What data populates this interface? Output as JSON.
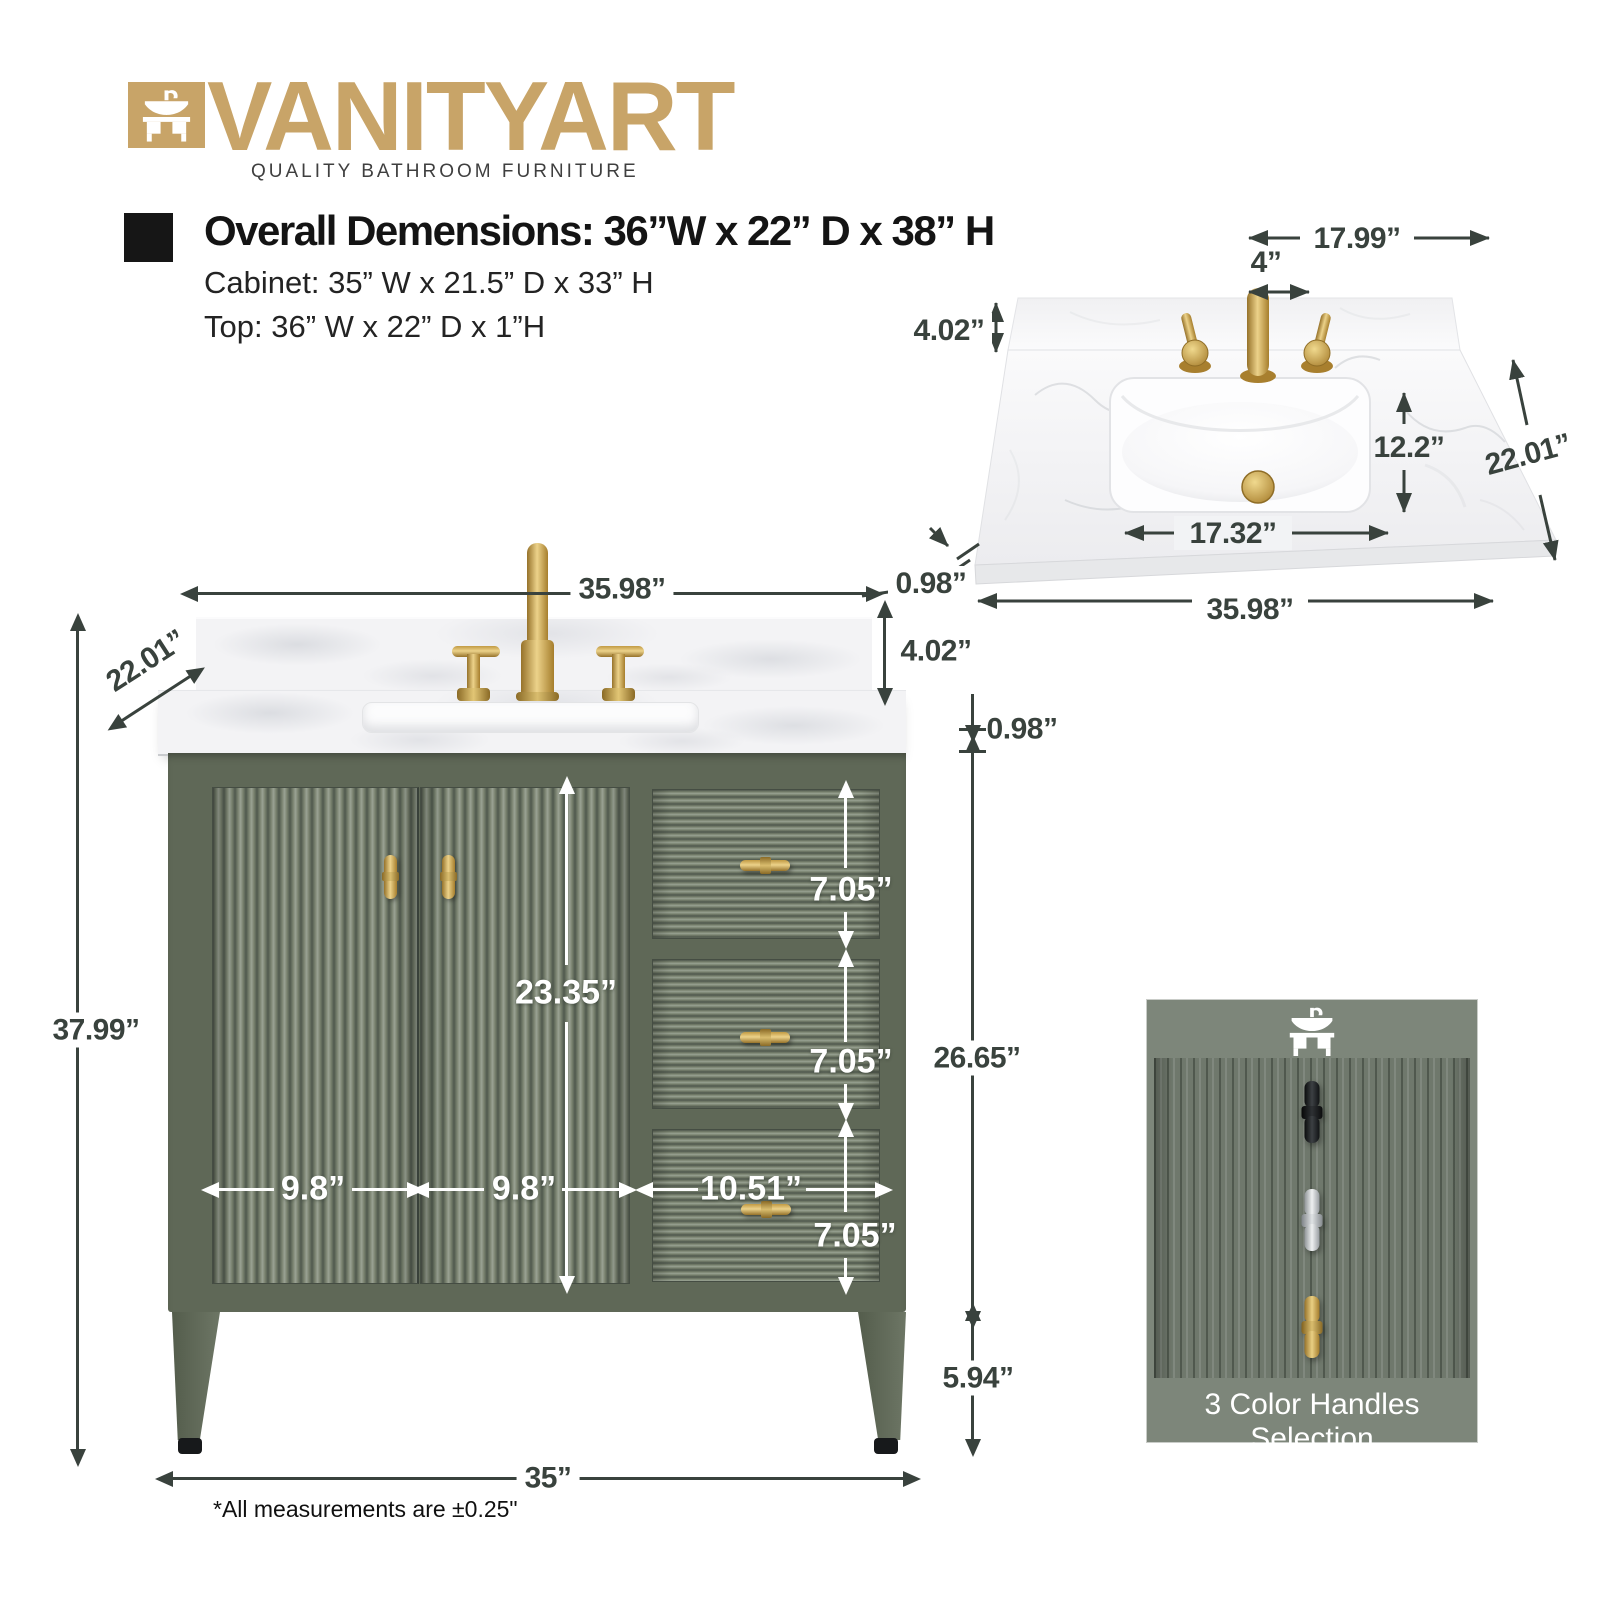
{
  "brand": {
    "logo_text": "VANITYART",
    "tagline": "QUALITY BATHROOM FURNITURE"
  },
  "specs": {
    "overall": "Overall Demensions: 36”W x 22” D x 38” H",
    "cabinet": "Cabinet: 35” W x 21.5” D x 33” H",
    "top": "Top: 36” W x 22” D x 1”H"
  },
  "top_view": {
    "dims": {
      "faucet_span": "17.99”",
      "hole_spacing": "4”",
      "backsplash_height": "4.02”",
      "sink_front_to_back": "12.2”",
      "counter_depth": "22.01”",
      "sink_width": "17.32”",
      "counter_thickness": "0.98”",
      "counter_width": "35.98”"
    }
  },
  "front_view": {
    "dims": {
      "counter_width": "35.98”",
      "counter_depth": "22.01”",
      "backsplash_height": "4.02”",
      "counter_thickness": "0.98”",
      "door_height": "23.35”",
      "drawer_height": "7.05”",
      "cabinet_side_height": "26.65”",
      "door_width": "9.8”",
      "drawer_width": "10.51”",
      "overall_height": "37.99”",
      "leg_height": "5.94”",
      "cabinet_width": "35”"
    }
  },
  "handles_panel": {
    "title": "3 Color Handles Selection",
    "options": [
      {
        "name": "black"
      },
      {
        "name": "chrome"
      },
      {
        "name": "gold"
      }
    ]
  },
  "footnote": "*All measurements are ±0.25\"",
  "colors": {
    "brand_gold": "#c8a468",
    "cabinet_green": "#5f6857",
    "panel_green": "#7d867a",
    "hardware_gold": "#c7a045",
    "dimension_text": "#39423d"
  }
}
